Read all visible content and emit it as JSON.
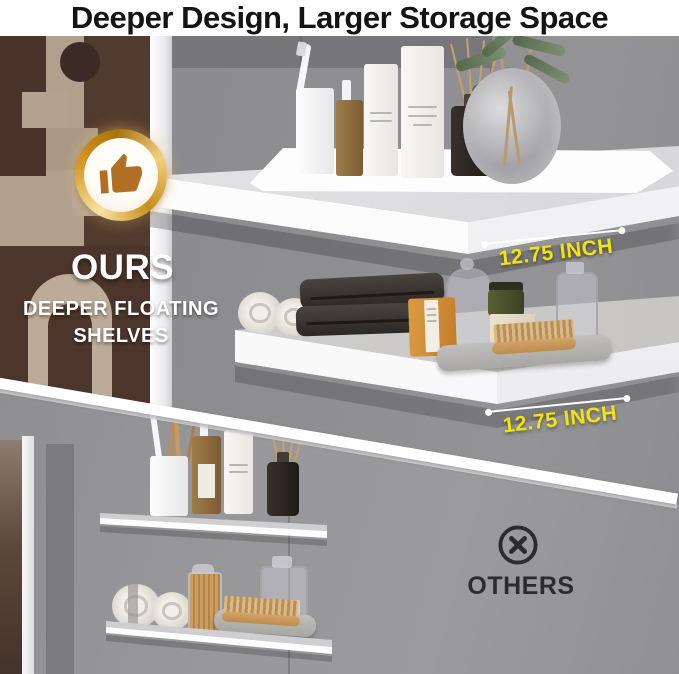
{
  "title": "Deeper Design, Larger Storage Space",
  "ours": {
    "badge_icon": "thumbs-up-icon",
    "label": "OURS",
    "subtitle": "DEEPER FLOATING SHELVES"
  },
  "measurements": {
    "top_shelf": "12.75 INCH",
    "bottom_shelf": "12.75 INCH"
  },
  "others": {
    "icon": "circled-x-icon",
    "label": "OTHERS"
  },
  "colors": {
    "accent_yellow": "#F2E50C",
    "badge_gold": "#D79A26",
    "thumb_brown": "#B26E22",
    "others_dark": "#2C2C2E",
    "wall_gray": "#8E8E91",
    "shelf_white": "#FAFAFB"
  }
}
